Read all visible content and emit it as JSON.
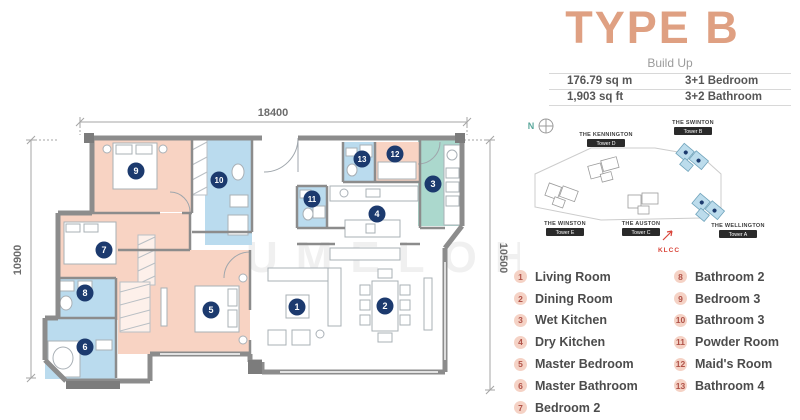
{
  "title": "TYPE B",
  "build_up": {
    "label": "Build Up",
    "rows": [
      [
        "176.79 sq m",
        "3+1 Bedroom"
      ],
      [
        "1,903 sq ft",
        "3+2 Bathroom"
      ]
    ]
  },
  "site_map": {
    "compass_label": "N",
    "landmark": "KLCC",
    "towers": [
      {
        "name": "THE KENNINGTON",
        "tower": "Tower D",
        "highlighted": false,
        "label_x": 101,
        "label_y": 24,
        "cx": 100,
        "cy": 57,
        "rot": -15
      },
      {
        "name": "THE SWINTON",
        "tower": "Tower B",
        "highlighted": true,
        "label_x": 188,
        "label_y": 12,
        "cx": 187,
        "cy": 47,
        "rot": 40
      },
      {
        "name": "THE WINSTON",
        "tower": "Tower E",
        "highlighted": false,
        "label_x": 60,
        "label_y": 113,
        "cx": 57,
        "cy": 83,
        "rot": 20
      },
      {
        "name": "THE AUSTON",
        "tower": "Tower C",
        "highlighted": false,
        "label_x": 136,
        "label_y": 113,
        "cx": 139,
        "cy": 90,
        "rot": 0
      },
      {
        "name": "THE WELLINGTON",
        "tower": "Tower A",
        "highlighted": true,
        "label_x": 233,
        "label_y": 115,
        "cx": 203,
        "cy": 97,
        "rot": 40
      }
    ]
  },
  "legend": [
    {
      "num": "1",
      "label": "Living Room"
    },
    {
      "num": "2",
      "label": "Dining Room"
    },
    {
      "num": "3",
      "label": "Wet Kitchen"
    },
    {
      "num": "4",
      "label": "Dry Kitchen"
    },
    {
      "num": "5",
      "label": "Master Bedroom"
    },
    {
      "num": "6",
      "label": "Master Bathroom"
    },
    {
      "num": "7",
      "label": "Bedroom 2"
    },
    {
      "num": "8",
      "label": "Bathroom 2"
    },
    {
      "num": "9",
      "label": "Bedroom 3"
    },
    {
      "num": "10",
      "label": "Bathroom 3"
    },
    {
      "num": "11",
      "label": "Powder Room"
    },
    {
      "num": "12",
      "label": "Maid's Room"
    },
    {
      "num": "13",
      "label": "Bathroom 4"
    }
  ],
  "floor_plan": {
    "dimensions": {
      "top": "18400",
      "left": "10900",
      "right": "10500"
    },
    "colors": {
      "salmon": "#f8d3c3",
      "blue": "#badbee",
      "teal": "#abd8cd",
      "white": "#ffffff",
      "badge": "#1c3a6e"
    },
    "rooms": [
      {
        "num": "1",
        "name": "Living Room",
        "color": "white",
        "badge": [
          297,
          307
        ]
      },
      {
        "num": "2",
        "name": "Dining Room",
        "color": "white",
        "badge": [
          385,
          306
        ]
      },
      {
        "num": "3",
        "name": "Wet Kitchen",
        "color": "teal",
        "rect": [
          418,
          140,
          44,
          86
        ],
        "badge": [
          433,
          184
        ]
      },
      {
        "num": "4",
        "name": "Dry Kitchen",
        "color": "white",
        "badge": [
          377,
          214
        ]
      },
      {
        "num": "5",
        "name": "Master Bedroom",
        "color": "salmon",
        "rect": [
          118,
          250,
          132,
          104
        ],
        "badge": [
          211,
          310
        ]
      },
      {
        "num": "6",
        "name": "Master Bathroom",
        "color": "blue",
        "rect": [
          45,
          318,
          71,
          61
        ],
        "badge": [
          85,
          347
        ]
      },
      {
        "num": "7",
        "name": "Bedroom 2",
        "color": "salmon",
        "rect": [
          58,
          213,
          132,
          107
        ],
        "badge": [
          104,
          250
        ]
      },
      {
        "num": "8",
        "name": "Bathroom 2",
        "color": "blue",
        "rect": [
          58,
          278,
          58,
          41
        ],
        "badge": [
          85,
          293
        ]
      },
      {
        "num": "9",
        "name": "Bedroom 3",
        "color": "salmon",
        "rect": [
          92,
          138,
          100,
          74
        ],
        "badge": [
          136,
          171
        ]
      },
      {
        "num": "10",
        "name": "Bathroom 3",
        "color": "blue",
        "rect": [
          205,
          138,
          47,
          107
        ],
        "badge": [
          219,
          180
        ]
      },
      {
        "num": "11",
        "name": "Powder Room",
        "color": "blue",
        "rect": [
          297,
          186,
          30,
          42
        ],
        "badge": [
          312,
          199
        ]
      },
      {
        "num": "12",
        "name": "Maid's Room",
        "color": "salmon",
        "rect": [
          375,
          142,
          45,
          40
        ],
        "badge": [
          395,
          154
        ]
      },
      {
        "num": "13",
        "name": "Bathroom 4",
        "color": "blue",
        "rect": [
          343,
          142,
          32,
          40
        ],
        "badge": [
          362,
          159
        ]
      }
    ]
  },
  "watermark": "UMELOH"
}
